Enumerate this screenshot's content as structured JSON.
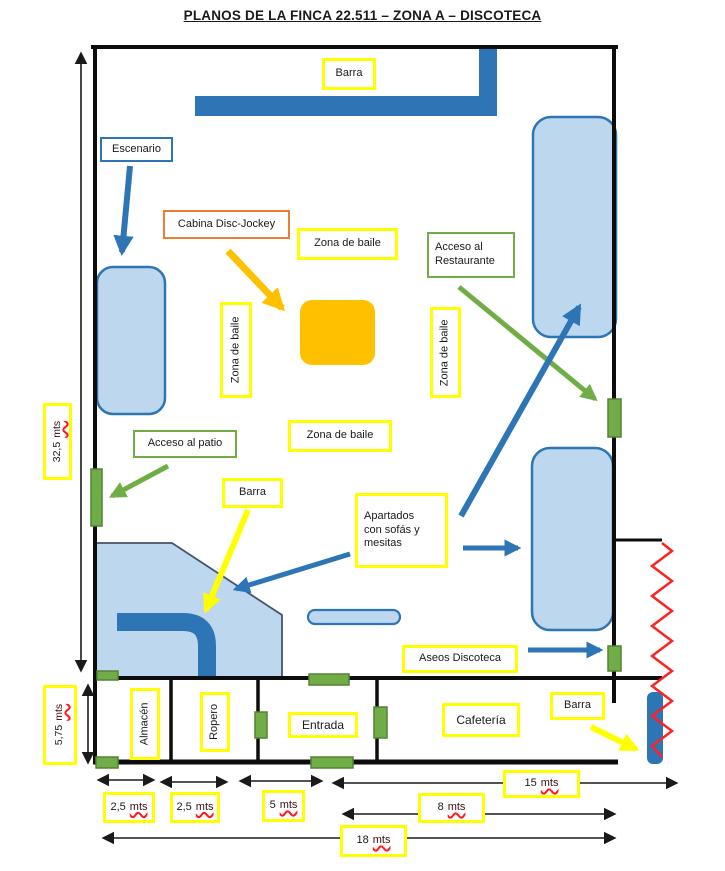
{
  "title": "PLANOS DE LA FINCA 22.511 – ZONA A – DISCOTECA",
  "rooms": {
    "barra_top": "Barra",
    "escenario": "Escenario",
    "cabina_dj": "Cabina Disc-Jockey",
    "zona_baile_top": "Zona de baile",
    "zona_baile_left": "Zona de baile",
    "zona_baile_right": "Zona de baile",
    "zona_baile_center": "Zona de baile",
    "acceso_restaurante_line1": "Acceso al",
    "acceso_restaurante_line2": "Restaurante",
    "acceso_patio": "Acceso al patio",
    "barra_central": "Barra",
    "apartados_line1": "Apartados",
    "apartados_line2": "con sofás y",
    "apartados_line3": "mesitas",
    "aseos": "Aseos Discoteca",
    "almacen": "Almacén",
    "ropero": "Ropero",
    "entrada": "Entrada",
    "cafeteria": "Cafetería",
    "barra_cafeteria": "Barra"
  },
  "dimensions": {
    "total_height": {
      "value": "32,5",
      "unit": "mts"
    },
    "strip_height": {
      "value": "5,75",
      "unit": "mts"
    },
    "almacen_width": {
      "value": "2,5",
      "unit": "mts"
    },
    "ropero_width": {
      "value": "2,5",
      "unit": "mts"
    },
    "entrada_width": {
      "value": "5",
      "unit": "mts"
    },
    "cafeteria_width": {
      "value": "15",
      "unit": "mts"
    },
    "right_section_width": {
      "value": "8",
      "unit": "mts"
    },
    "total_width": {
      "value": "18",
      "unit": "mts"
    }
  },
  "colors": {
    "accent_blue": "#2E75B6",
    "light_blue_fill": "#BDD7EE",
    "label_yellow": "#FFFF00",
    "door_green": "#70AD47",
    "door_green_border": "#548235",
    "orange_border": "#ED7D31",
    "dj_square_gold": "#FFC000",
    "zigzag_red": "#FF2222",
    "wall_black": "#0d0d0d"
  }
}
